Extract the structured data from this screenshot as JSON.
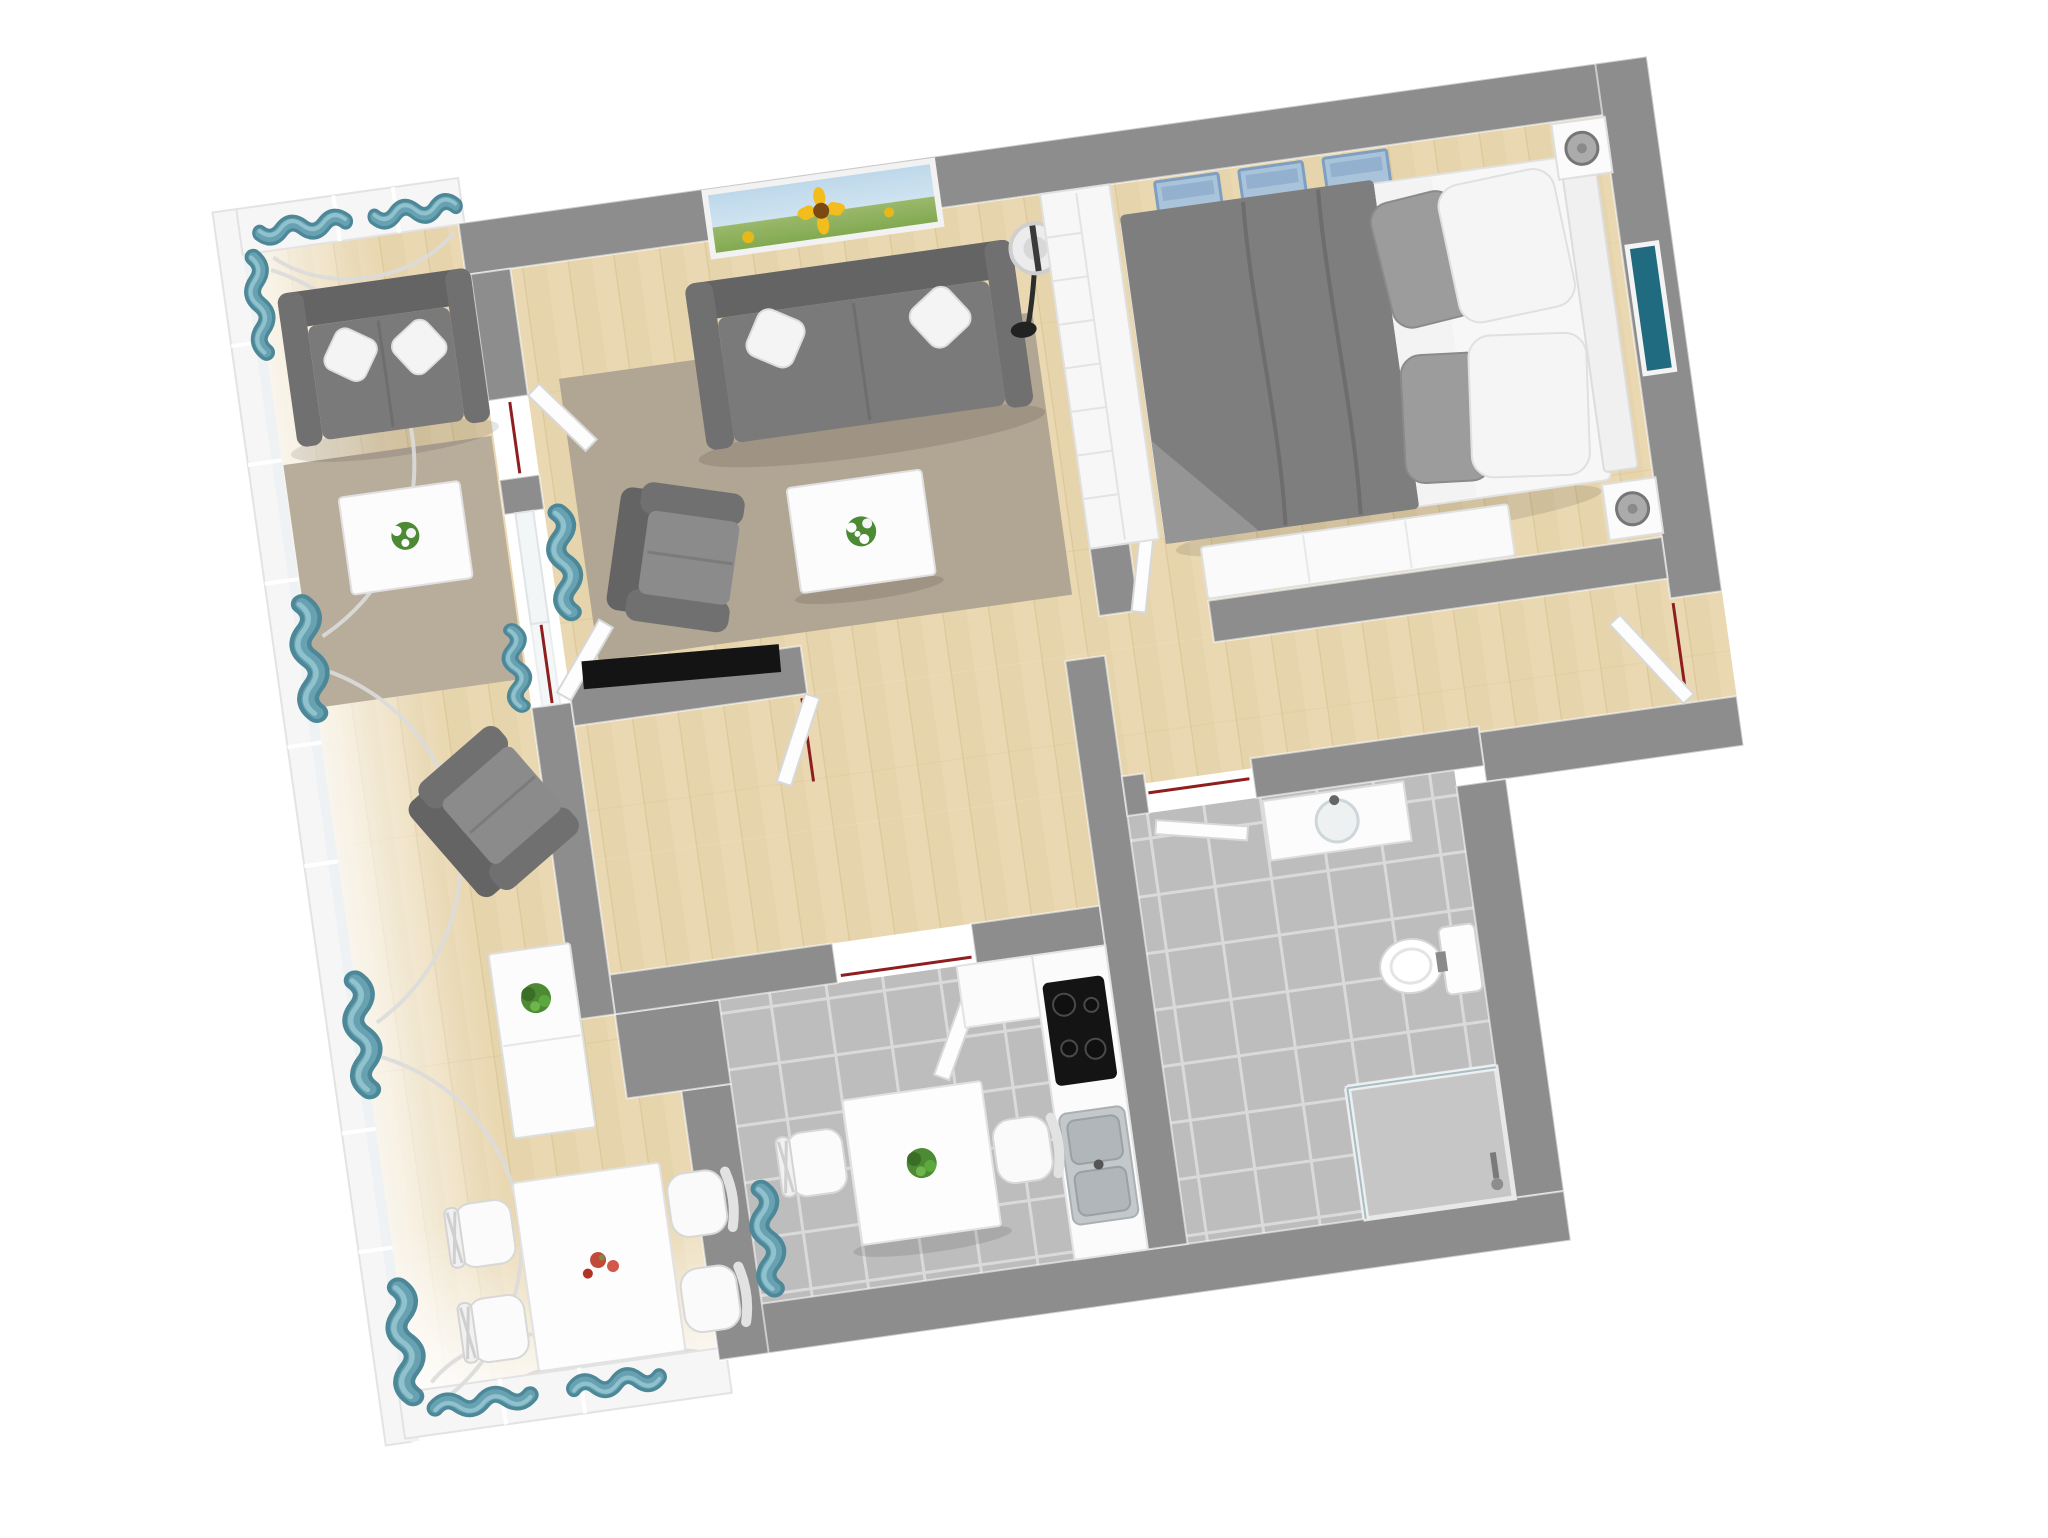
{
  "scene": {
    "title": "3D apartment floor plan, top-down view",
    "rotation_deg": -8,
    "background": "#ffffff"
  },
  "colors": {
    "bg": "#ffffff",
    "wall": "#8d8d8d",
    "wallEdge": "#f2f2f2",
    "innerWall": "#f4f4f4",
    "wood": "#ead8b2",
    "woodLine": "#d9c494",
    "tile": "#bdbdbd",
    "tileLine": "#dadada",
    "rugLiving": "#b1a593",
    "rugSunroom": "#b8ac9b",
    "sofa": "#7a7a7a",
    "sofaDark": "#646464",
    "sofaSeat": "#8b8b8b",
    "pillowWhite": "#f4f4f4",
    "pillowGray": "#9c9c9c",
    "curtain": "#68a2b2",
    "curtainDark": "#4d8898",
    "curtainLight": "#8fc2cd",
    "shelfBlue": "#a9c3db",
    "shelfBlueDark": "#7f9fc0",
    "duvet": "#7e7e7e",
    "bedWhite": "#f7f7f7",
    "counter": "#fbfbfb",
    "steel": "#c3c8cb",
    "cooktop": "#141414",
    "tv": "#141414",
    "plant": "#4c8a33",
    "plantDark": "#3a6e25",
    "flowerRed": "#c14b38",
    "artTeal": "#206b7f",
    "doorSwing": "#8f1f1f",
    "windowFrame": "#f6f6f6",
    "glassArc": "#dcdcdc"
  },
  "rooms": [
    {
      "id": "living-room",
      "name": "Living room",
      "floor": "light wood, gray-beige rug"
    },
    {
      "id": "bedroom",
      "name": "Bedroom",
      "floor": "light wood"
    },
    {
      "id": "kitchen",
      "name": "Kitchen",
      "floor": "gray tile"
    },
    {
      "id": "bathroom",
      "name": "Bathroom",
      "floor": "gray tile"
    },
    {
      "id": "sunroom",
      "name": "Sunroom with arched windows",
      "floor": "light wood"
    },
    {
      "id": "hallway",
      "name": "Hallway / entry",
      "floor": "light wood"
    }
  ],
  "furniture": {
    "living_room": [
      "gray sofa with 2 white pillows",
      "gray armchair",
      "white coffee table with white flowers",
      "sunflower painting on wall",
      "floor lamp",
      "TV on partition stub wall",
      "white bookshelf room divider"
    ],
    "bedroom": [
      "double bed with gray duvet, gray and white pillows",
      "white headboard",
      "2 nightstands with gray lamps",
      "3 blue wall cube shelves with plants",
      "teal artwork on wall",
      "white dresser at bed foot"
    ],
    "kitchen": [
      "white counter with black cooktop",
      "double stainless sink",
      "white square table with plant",
      "2 white chairs",
      "teal window curtain"
    ],
    "bathroom": [
      "vanity with round basin",
      "toilet",
      "corner glass shower",
      "white door leaf"
    ],
    "sunroom": [
      "gray loveseat with 2 white pillows",
      "white coffee table with flowers",
      "gray armchair",
      "white sideboard with plant",
      "white dining table with red flowers",
      "4 white chairs",
      "teal curtains on arched windows"
    ],
    "hallway": [
      "open white entry door",
      "door swing markers"
    ]
  },
  "door_markers": {
    "color": "#8f1f1f",
    "count": 6
  }
}
